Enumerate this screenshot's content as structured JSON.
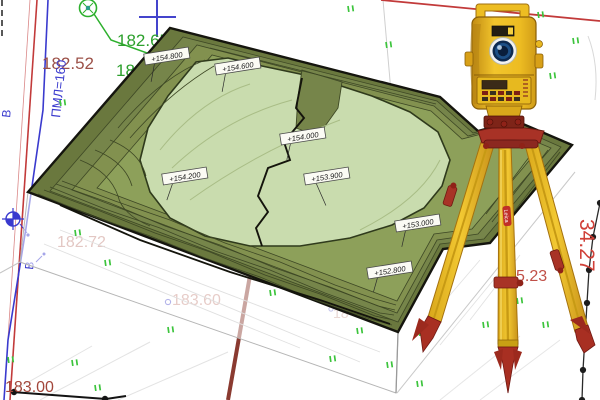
{
  "meta": {
    "description": "Topographic survey CAD plan with pasted 3D contour terrain block and a Leica total station on a wooden tripod",
    "width": 600,
    "height": 400
  },
  "map": {
    "elevation_labels": [
      {
        "text": "+154.800",
        "x": 148,
        "y": 62
      },
      {
        "text": "+154.600",
        "x": 219,
        "y": 72
      },
      {
        "text": "+154.200",
        "x": 166,
        "y": 182
      },
      {
        "text": "+154.000",
        "x": 284,
        "y": 142
      },
      {
        "text": "+153.900",
        "x": 308,
        "y": 182
      },
      {
        "text": "+153.000",
        "x": 399,
        "y": 229
      },
      {
        "text": "+152.800",
        "x": 371,
        "y": 276
      }
    ],
    "spot_heights": [
      {
        "text": "182.65",
        "color": "#2da02d"
      },
      {
        "text": "180.8",
        "color": "#2da02d"
      },
      {
        "text": "182.52",
        "color": "#9c5148"
      },
      {
        "text": "182.72",
        "color": "#c1847b"
      },
      {
        "text": "183.60",
        "color": "#c98f86"
      },
      {
        "text": "183.00",
        "color": "#a2463a"
      },
      {
        "text": "5.23",
        "color": "#c05048"
      },
      {
        "text": "34.27",
        "color": "#d04038"
      },
      {
        "text": "ПМЛ=160",
        "color": "#3a3ace"
      },
      {
        "text": "В",
        "color": "#3a3ace"
      },
      {
        "text": "В",
        "color": "#3a3ace"
      },
      {
        "text": "18",
        "color": "#d0a89f"
      }
    ],
    "grass_marks": [
      [
        60,
        100
      ],
      [
        348,
        6
      ],
      [
        478,
        8
      ],
      [
        538,
        12
      ],
      [
        573,
        38
      ],
      [
        386,
        42
      ],
      [
        550,
        73
      ],
      [
        75,
        230
      ],
      [
        105,
        260
      ],
      [
        168,
        327
      ],
      [
        270,
        290
      ],
      [
        8,
        357
      ],
      [
        72,
        360
      ],
      [
        95,
        385
      ],
      [
        357,
        328
      ],
      [
        330,
        356
      ],
      [
        387,
        362
      ],
      [
        419,
        330
      ],
      [
        417,
        381
      ],
      [
        483,
        322
      ],
      [
        543,
        322
      ],
      [
        517,
        298
      ]
    ],
    "fence_points": [
      [
        600,
        203
      ],
      [
        593,
        237
      ],
      [
        589,
        270
      ],
      [
        587,
        303
      ],
      [
        585,
        337
      ],
      [
        583,
        370
      ],
      [
        582,
        400
      ]
    ],
    "colors": {
      "terrain_dark": "#6a783e",
      "terrain_band2": "#76854a",
      "terrain_band3": "#82914f",
      "terrain_band4": "#8da05a",
      "terrain_pale": "#c9dcae",
      "contour_thin": "#3e4825",
      "contour_bold": "#14140c",
      "grass_green": "#3cc43c",
      "cad_red": "#c23a3a",
      "cad_blue": "#3a3ace",
      "cad_green": "#2da02d",
      "maroon_line": "#8a3a30"
    }
  },
  "instrument": {
    "brand": "Leica",
    "type": "total station on wooden tripod",
    "body_yellow": "#f0c020",
    "accent_red": "#a83226"
  }
}
